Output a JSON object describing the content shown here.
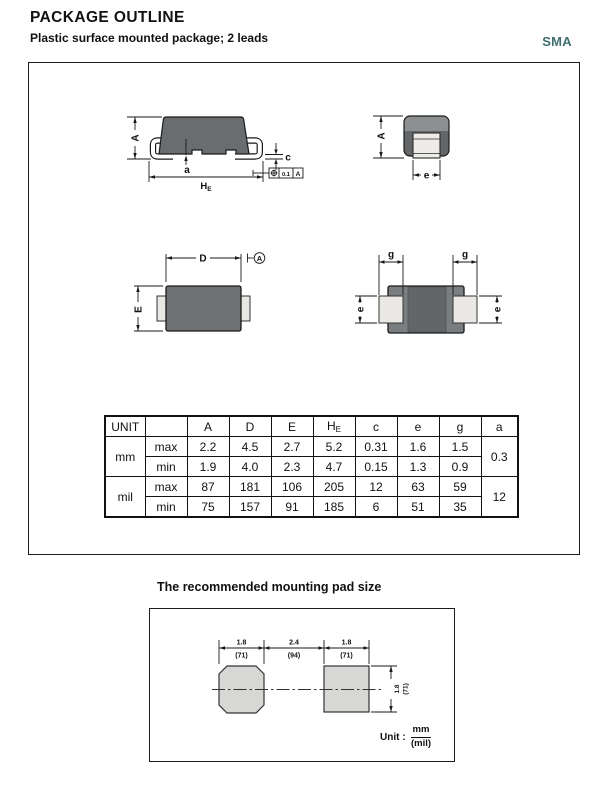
{
  "header": {
    "title": "PACKAGE  OUTLINE",
    "subtitle": "Plastic surface mounted package; 2 leads",
    "package_code": "SMA"
  },
  "colors": {
    "accent_teal": "#3f6f6f",
    "body_dark": "#696d6f",
    "body_light": "#8d9092",
    "pad_gray": "#d7d7d5",
    "line": "#1a1a1a"
  },
  "front_view": {
    "dim_A": "A",
    "dim_a": "a",
    "dim_HE_main": "H",
    "dim_HE_sub": "E",
    "dim_c": "c",
    "tolerance_frame": {
      "value": "0.1",
      "datum": "A"
    }
  },
  "end_view": {
    "dim_A": "A",
    "dim_e": "e"
  },
  "top_view": {
    "dim_D": "D",
    "dim_E": "E",
    "datum_label": "A"
  },
  "bottom_view": {
    "dim_g_left": "g",
    "dim_g_right": "g",
    "dim_e_left": "e",
    "dim_e_right": "e"
  },
  "dimension_table": {
    "unit_label": "UNIT",
    "col_A": "A",
    "col_D": "D",
    "col_E": "E",
    "col_HE_main": "H",
    "col_HE_sub": "E",
    "col_c": "c",
    "col_e": "e",
    "col_g": "g",
    "col_a": "a",
    "mm_label": "mm",
    "mil_label": "mil",
    "max_label": "max",
    "min_label": "min",
    "mm_max": [
      "2.2",
      "4.5",
      "2.7",
      "5.2",
      "0.31",
      "1.6",
      "1.5"
    ],
    "mm_min": [
      "1.9",
      "4.0",
      "2.3",
      "4.7",
      "0.15",
      "1.3",
      "0.9"
    ],
    "mm_a": "0.3",
    "mil_max": [
      "87",
      "181",
      "106",
      "205",
      "12",
      "63",
      "59"
    ],
    "mil_min": [
      "75",
      "157",
      "91",
      "185",
      "6",
      "51",
      "35"
    ],
    "mil_a": "12"
  },
  "mounting_pad": {
    "title": "The recommended mounting pad size",
    "top_dims": [
      {
        "mm": "1.8",
        "mil": "(71)"
      },
      {
        "mm": "2.4",
        "mil": "(94)"
      },
      {
        "mm": "1.8",
        "mil": "(71)"
      }
    ],
    "side_dim": {
      "mm": "1.8",
      "mil": "(71)"
    },
    "unit_prefix": "Unit :",
    "unit_numerator": "mm",
    "unit_denominator": "(mil)"
  }
}
